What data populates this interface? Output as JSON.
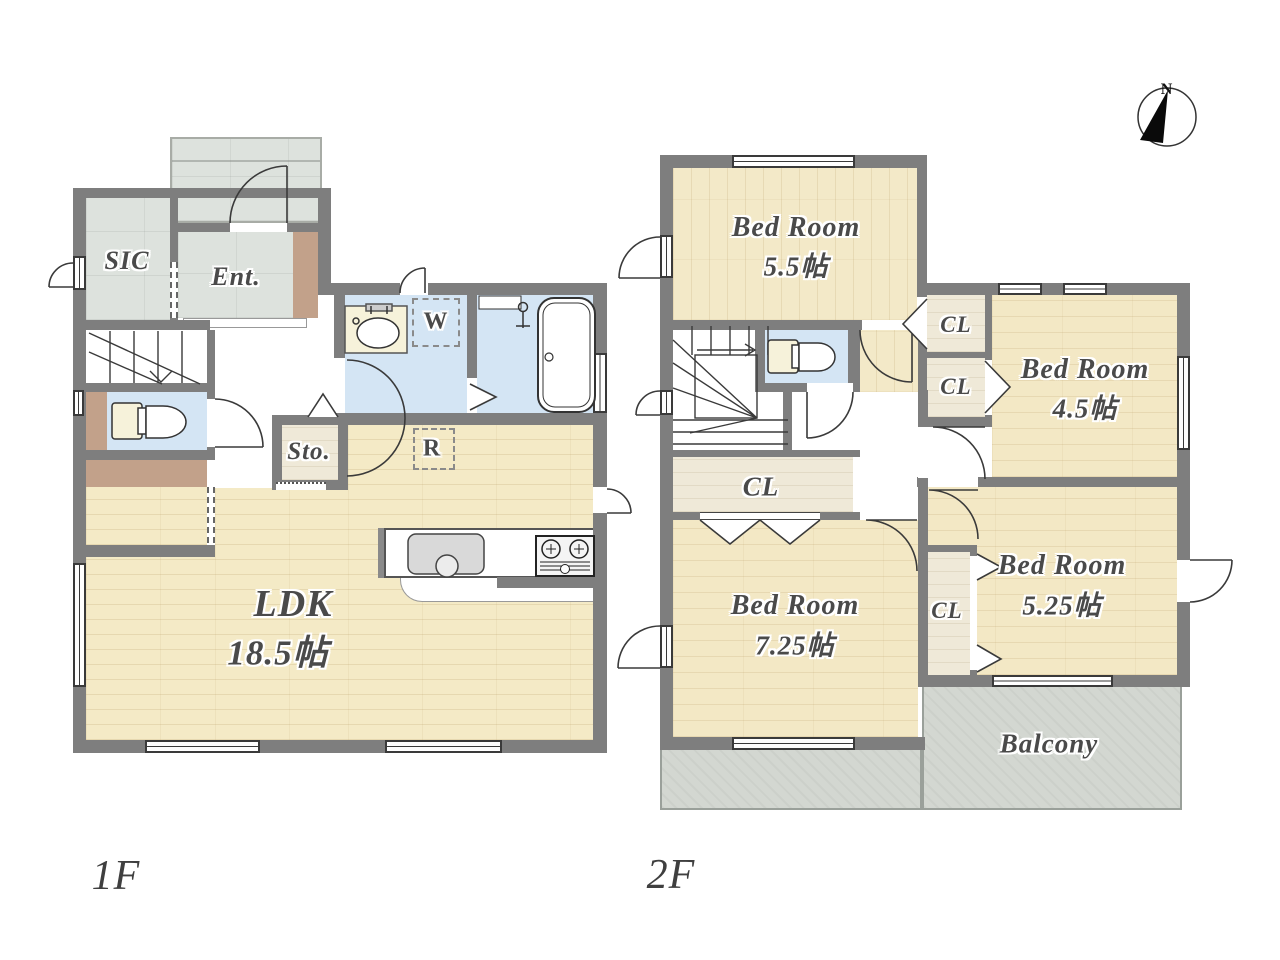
{
  "title": "Floor plan 1F / 2F",
  "f1": {
    "label": "1F",
    "sic": "SIC",
    "ent": "Ent.",
    "washer": "W",
    "fridge": "R",
    "storage": "Sto.",
    "ldk_name": "LDK",
    "ldk_size": "18.5帖"
  },
  "f2": {
    "label": "2F",
    "bed1_name": "Bed Room",
    "bed1_size": "5.5帖",
    "bed2_name": "Bed Room",
    "bed2_size": "4.5帖",
    "bed3_name": "Bed Room",
    "bed3_size": "5.25帖",
    "bed4_name": "Bed Room",
    "bed4_size": "7.25帖",
    "cl1": "CL",
    "cl2": "CL",
    "cl3": "CL",
    "cl4": "CL",
    "balcony": "Balcony"
  },
  "compass": {
    "north": "N"
  },
  "colors": {
    "wall": "#7e7e7e",
    "wood_floor": "#f4eac6",
    "wet_floor": "#d4e5f4",
    "entrance_tile": "#dde2dd",
    "balcony": "#d3d7d1",
    "accent_brown": "#c2a18a",
    "label_text": "#4a4a4a"
  }
}
